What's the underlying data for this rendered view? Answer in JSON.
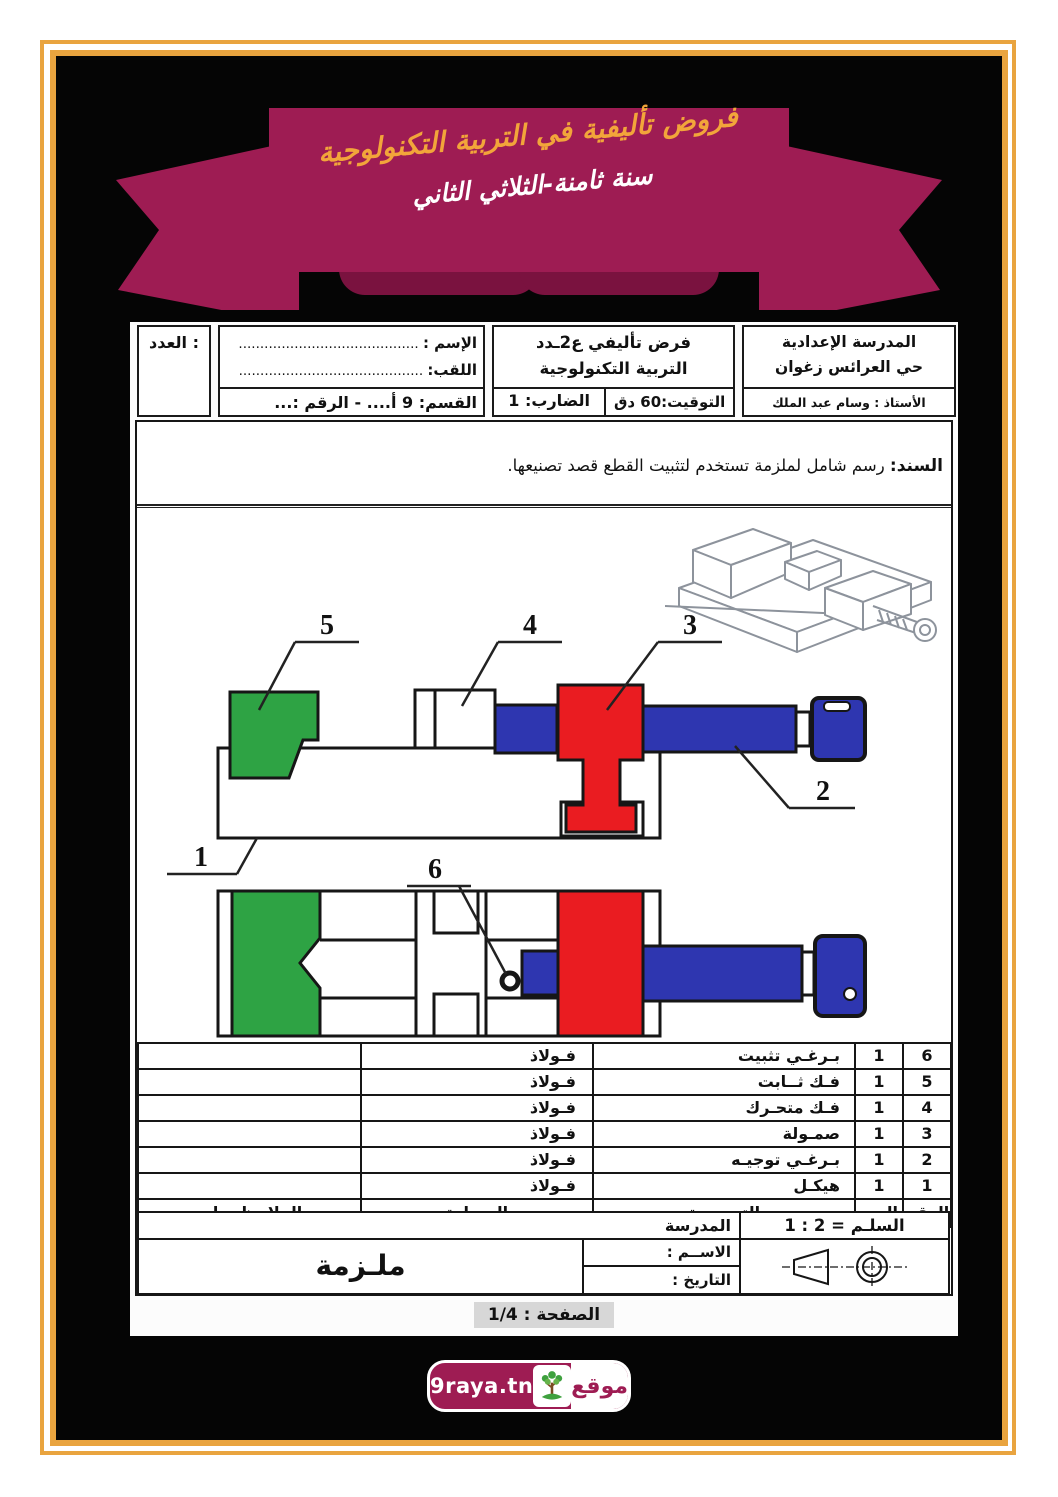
{
  "colors": {
    "frame_orange": "#E9A43F",
    "ribbon_maroon": "#9E1C53",
    "ribbon_fold": "#7A123F",
    "banner_orange": "#F2A53A",
    "part_green": "#2EA344",
    "part_red": "#EA1C21",
    "part_blue": "#2E36B0"
  },
  "banner": {
    "line1": "فروض تأليفية في التربية التكنولوجية",
    "line2": "سنة ثامنة-الثلاثي الثاني"
  },
  "header": {
    "grade_label": "العدد :",
    "student": {
      "name_label": "الإسم :",
      "name_dots": "..........................................",
      "surname_label": "اللقب:",
      "surname_dots": "...........................................",
      "class_line": "القسم: 9 أ.... - الرقم :..."
    },
    "exam": {
      "title1": "فرض تأليفي ع2ـدد",
      "title2": "التربية التكنولوجية",
      "timing": "التوقيت:60 دق",
      "coefficient": "الضارب: 1"
    },
    "school": {
      "line1": "المدرسة الإعدادية",
      "line2": "حي العرائس زغوان",
      "teacher": "الأستاذ : وسام عبد الملك"
    }
  },
  "support": {
    "label": "السند:",
    "text": "رسم شامل لملزمة تستخدم لتثبيت القطع قصد تصنيعها."
  },
  "figure": {
    "labels": {
      "l1": "1",
      "l2": "2",
      "l3": "3",
      "l4": "4",
      "l5": "5",
      "l6": "6"
    }
  },
  "parts_table": {
    "headers": {
      "num": "الرقم",
      "qty": "العدد",
      "name": "التسميــة",
      "material": "المـــادة",
      "notes": "الملاحظــــات"
    },
    "rows": [
      {
        "num": "6",
        "qty": "1",
        "name": "بـرغـي تثبيت",
        "material": "فـولاذ",
        "notes": ""
      },
      {
        "num": "5",
        "qty": "1",
        "name": "فـك ثــابت",
        "material": "فـولاذ",
        "notes": ""
      },
      {
        "num": "4",
        "qty": "1",
        "name": "فـك متحـرك",
        "material": "فـولاذ",
        "notes": ""
      },
      {
        "num": "3",
        "qty": "1",
        "name": "صمـولة",
        "material": "فـولاذ",
        "notes": ""
      },
      {
        "num": "2",
        "qty": "1",
        "name": "بـرغـي توجيـه",
        "material": "فـولاذ",
        "notes": ""
      },
      {
        "num": "1",
        "qty": "1",
        "name": "هيكـل",
        "material": "فـولاذ",
        "notes": ""
      }
    ]
  },
  "title_block": {
    "scale": "السلـم = 2 : 1",
    "school_label": "المدرسة",
    "name_label": "الاســم :",
    "date_label": "التاريخ :",
    "drawing_title": "ملـزمة"
  },
  "page_number": "الصفحة : 1/4",
  "logo": {
    "site": "9raya.tn",
    "word": "موقع"
  }
}
